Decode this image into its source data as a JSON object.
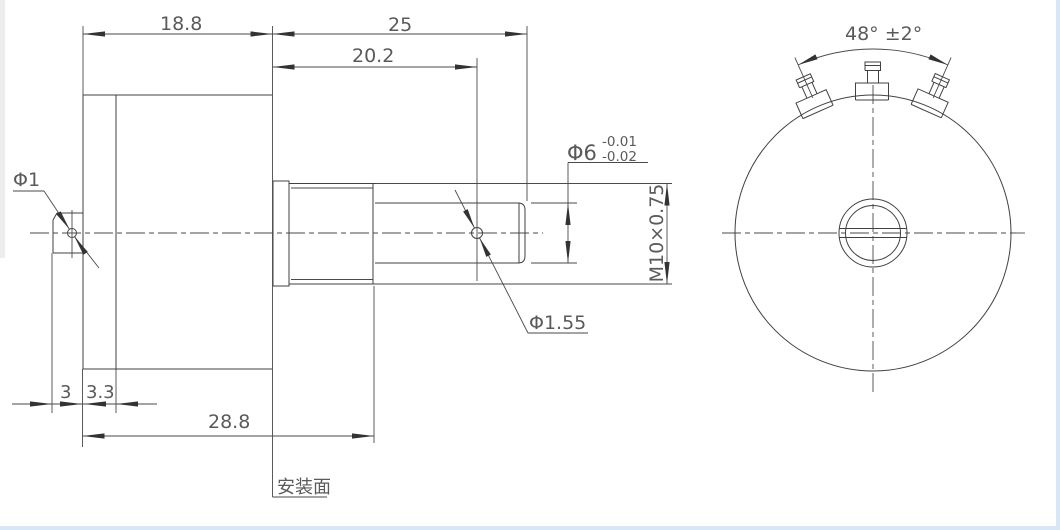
{
  "drawing": {
    "type": "engineering-drawing",
    "side_view": {
      "dims": {
        "body_length": "18.8",
        "shaft_length": "25",
        "bushing_length": "20.2",
        "tab_hole_dia": "Φ1",
        "rear_tab_depth": "3",
        "flange_depth": "3.3",
        "overall_length": "28.8",
        "shaft_dia": "Φ6",
        "shaft_tol_upper": "-0.01",
        "shaft_tol_lower": "-0.02",
        "thread_spec": "M10×0.75",
        "cross_hole_dia": "Φ1.55",
        "mounting_face_label": "安装面"
      }
    },
    "front_view": {
      "terminal_angle": "48° ±2°",
      "terminal_count": 3
    }
  },
  "colors": {
    "background": "#ffffff",
    "line": "#414141",
    "text": "#5a5a5a",
    "window_edge_blue": "#d9e6f5",
    "window_edge_gray": "#ededed"
  }
}
